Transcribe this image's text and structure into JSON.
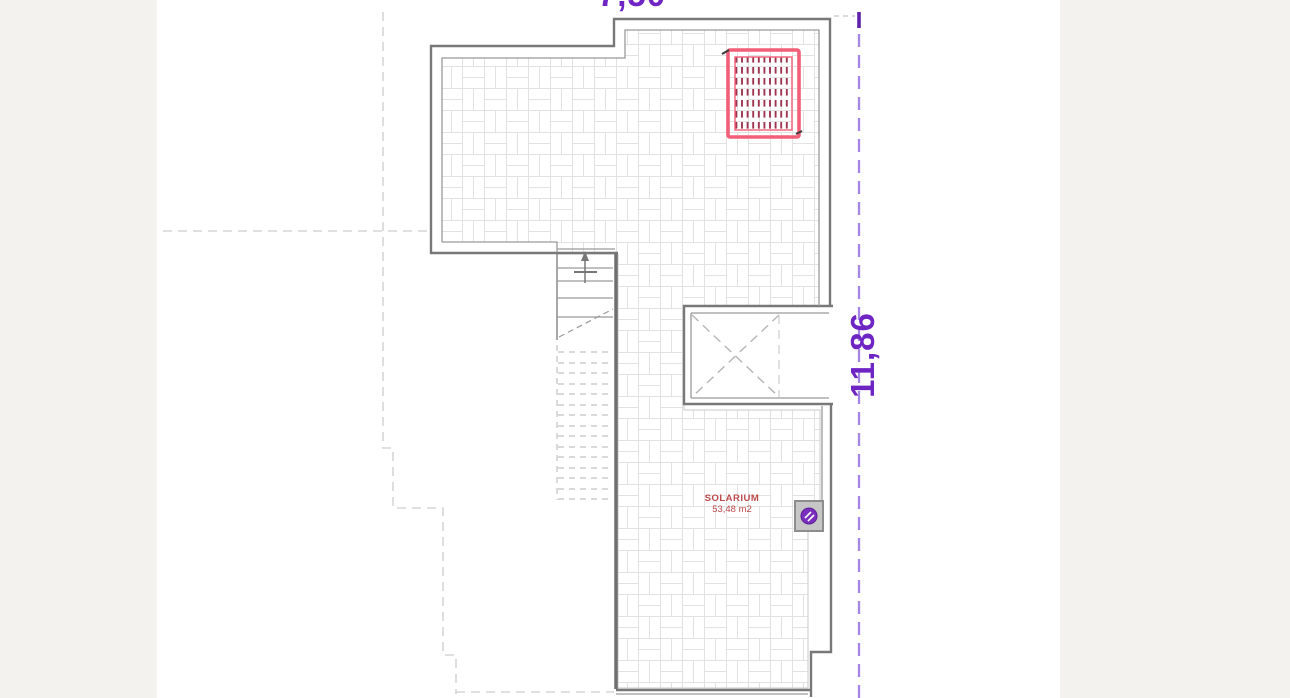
{
  "sheet": {
    "background": "#f4f2ee",
    "paper": "#ffffff"
  },
  "floor_plan": {
    "room": {
      "name": "SOLARIUM",
      "area": "53,48 m2"
    },
    "dimensions": {
      "right": "11,86",
      "top": "7,50"
    },
    "colors": {
      "dimension_text": "#6f24c4",
      "dimension_line": "#a585e5",
      "dimension_tick": "#5e21aa",
      "room_label_text": "#bd4a4a",
      "solar_panel_border": "#f25f78",
      "solar_panel_hatch": "#9e3550",
      "wall_outline": "#787878",
      "wall_inner": "#9a9a9a",
      "tile_joint": "#e2e2e2",
      "hidden_outline": "#cdcdcd",
      "fixture_fill": "#c6c6c6",
      "fixture_border": "#8d8d8d",
      "fixture_glyph": "#7b2fbe"
    }
  }
}
